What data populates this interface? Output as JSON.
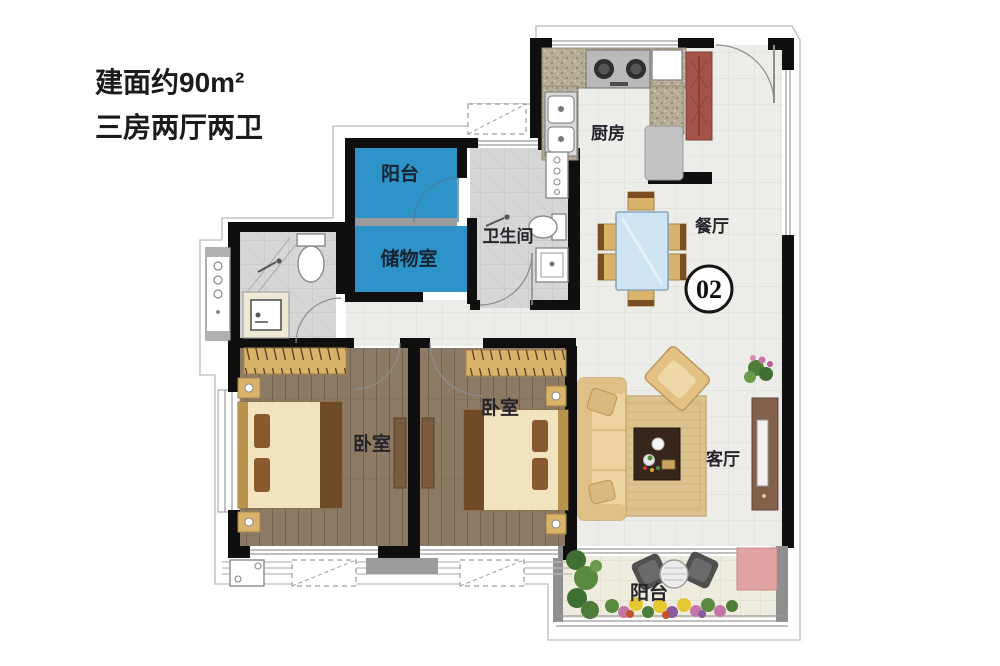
{
  "title": {
    "line1": "建面约90m²",
    "line2": "三房两厅两卫"
  },
  "unit_badge": {
    "number": "02"
  },
  "rooms": {
    "balcony_top": {
      "label": "阳台"
    },
    "storage": {
      "label": "储物室"
    },
    "bathroom": {
      "label": "卫生间"
    },
    "kitchen": {
      "label": "厨房"
    },
    "dining": {
      "label": "餐厅"
    },
    "living": {
      "label": "客厅"
    },
    "bedroom_left": {
      "label": "卧室"
    },
    "bedroom_middle": {
      "label": "卧室"
    },
    "balcony_bottom": {
      "label": "阳台"
    }
  },
  "colors": {
    "highlight_blue": "#2e93c9",
    "label_dark": "#16222f",
    "wall": "#0f0f0f",
    "contour": "#c6c6c6",
    "window_line": "#9a9a9a",
    "wood": "#8d7a64",
    "furn_tan": "#d9b36a",
    "bed_cream": "#f1e3bf",
    "pillow_brown": "#8a5a2e",
    "runner_brown": "#6f4b27",
    "cabinet_red": "#a3534a",
    "glass_blue": "#cfe4f2",
    "sofa_tan": "#ecd3a0",
    "rug_tan": "#dcc28e",
    "table_dark": "#37261b",
    "chair_dark": "#555555",
    "mat_pink": "#e2a3a3",
    "plant_green": "#4e7d3a",
    "flower_yellow": "#e8c832",
    "flower_pink": "#c576a8"
  }
}
